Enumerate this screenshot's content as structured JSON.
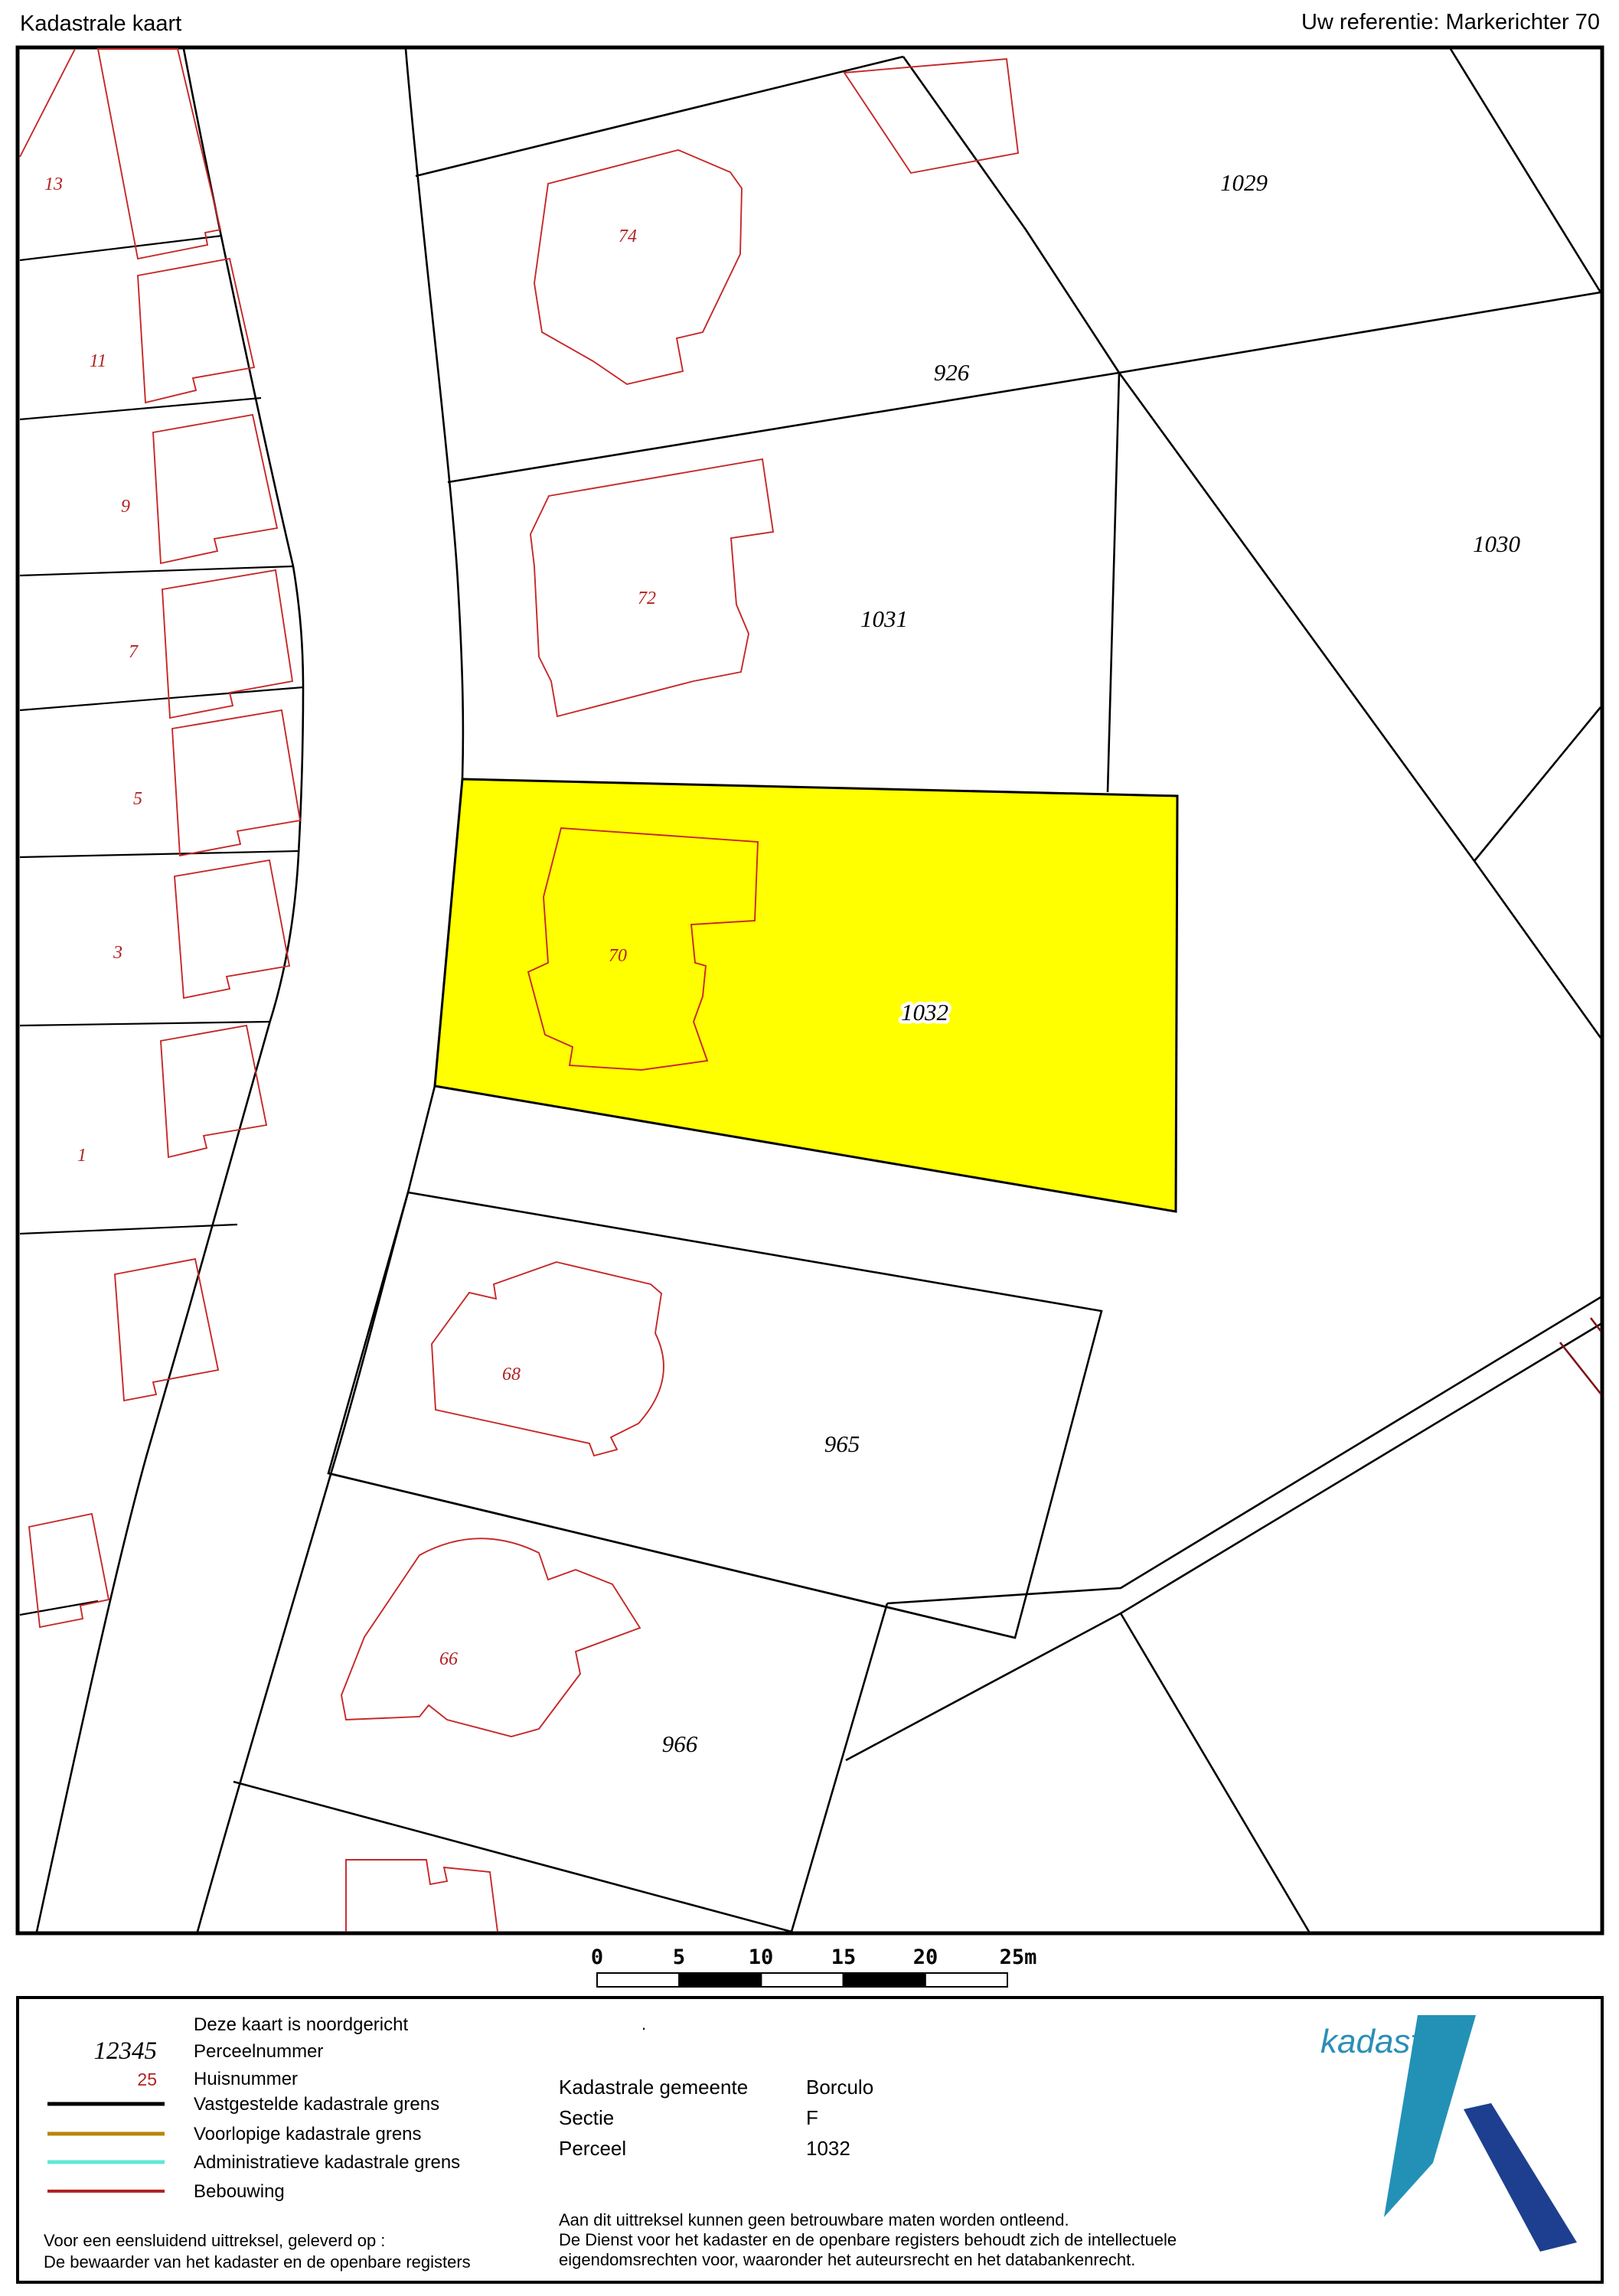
{
  "header": {
    "title": "Kadastrale kaart",
    "reference": "Uw referentie: Markerichter 70"
  },
  "map": {
    "highlight_color": "#ffff00",
    "highlighted_parcel": "1032",
    "parcel_labels": [
      {
        "text": "926"
      },
      {
        "text": "1029"
      },
      {
        "text": "1030"
      },
      {
        "text": "1031"
      },
      {
        "text": "1032"
      },
      {
        "text": "965"
      },
      {
        "text": "966"
      }
    ],
    "house_numbers": [
      {
        "text": "74"
      },
      {
        "text": "72"
      },
      {
        "text": "70"
      },
      {
        "text": "68"
      },
      {
        "text": "66"
      },
      {
        "text": "13"
      },
      {
        "text": "11"
      },
      {
        "text": "9"
      },
      {
        "text": "7"
      },
      {
        "text": "5"
      },
      {
        "text": "3"
      },
      {
        "text": "1"
      }
    ],
    "scale_bar": {
      "labels": [
        "0",
        "5",
        "10",
        "15",
        "20",
        "25m"
      ]
    }
  },
  "legend": {
    "north_note": "Deze kaart is noordgericht",
    "samples": [
      {
        "symbol": "12345",
        "label": "Perceelnummer"
      },
      {
        "symbol": "25",
        "label": "Huisnummer"
      }
    ],
    "line_items": [
      {
        "label": "Vastgestelde kadastrale grens",
        "color": "#000000"
      },
      {
        "label": "Voorlopige kadastrale grens",
        "color": "#b8860b"
      },
      {
        "label": "Administratieve kadastrale grens",
        "color": "#5fe8d5"
      },
      {
        "label": "Bebouwing",
        "color": "#b22222"
      }
    ],
    "footer_lines": [
      "Voor een eensluidend uittreksel, geleverd op :",
      "De bewaarder van het kadaster en de openbare registers"
    ],
    "map_info": {
      "dot": ".",
      "rows": [
        {
          "label": "Kadastrale gemeente",
          "value": "Borculo"
        },
        {
          "label": "Sectie",
          "value": "F"
        },
        {
          "label": "Perceel",
          "value": "1032"
        }
      ],
      "disclaimer": [
        "Aan dit uittreksel kunnen geen betrouwbare maten worden ontleend.",
        "De Dienst voor het kadaster en de openbare registers behoudt zich de intellectuele",
        "eigendomsrechten voor, waaronder het auteursrecht en het databankenrecht."
      ]
    },
    "logo": {
      "text": "kadaster",
      "blade_color": "#2391b5",
      "bar_color": "#1e3f8f"
    }
  }
}
